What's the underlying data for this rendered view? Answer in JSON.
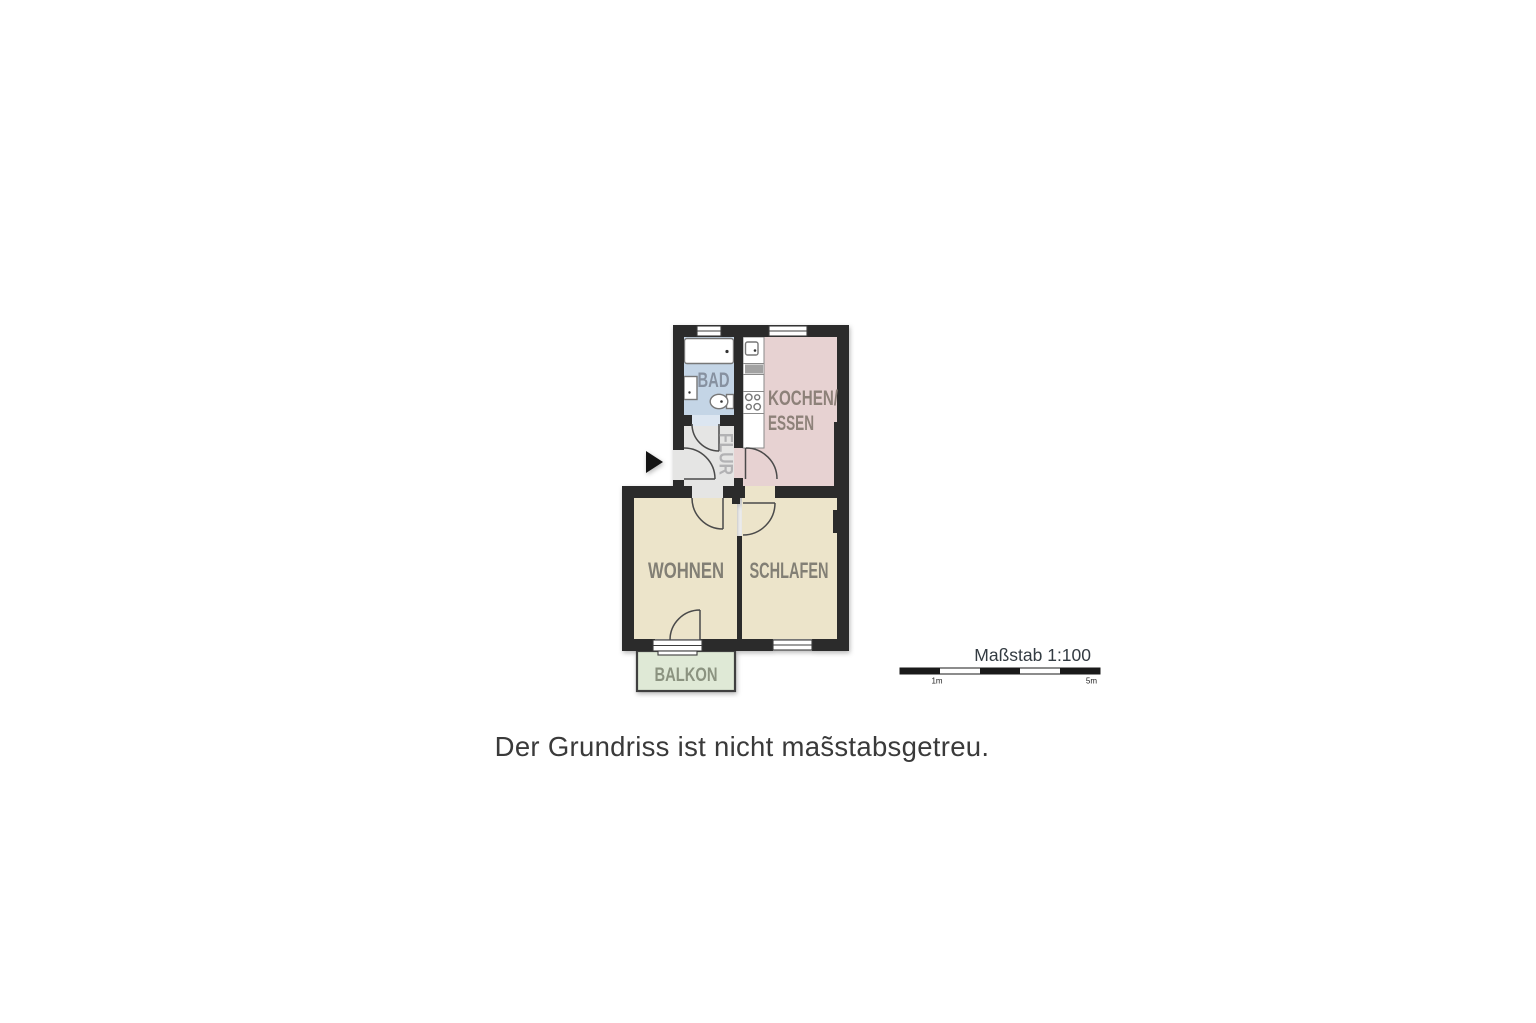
{
  "plan": {
    "rooms": [
      {
        "id": "bad",
        "label": "BAD",
        "fill": "#c4d5e6",
        "label_color": "#8791a0"
      },
      {
        "id": "kochen_essen",
        "label_line1": "KOCHEN/",
        "label_line2": "ESSEN",
        "fill": "#e7d2d2",
        "label_color": "#8d8179"
      },
      {
        "id": "flur",
        "label": "FLUR",
        "fill": "#e5e5e4",
        "label_color": "#b2b2b4"
      },
      {
        "id": "wohnen",
        "label": "WOHNEN",
        "fill": "#ece4ca",
        "label_color": "#827f75"
      },
      {
        "id": "schlafen",
        "label": "SCHLAFEN",
        "fill": "#ece4ca",
        "label_color": "#827f75"
      },
      {
        "id": "balkon",
        "label": "BALKON",
        "fill": "#dfe9d6",
        "label_color": "#8b9380"
      }
    ],
    "fixtures": [
      "bathtub",
      "bath-sink",
      "toilet",
      "kitchen-sink",
      "kitchen-hatch",
      "cooktop"
    ],
    "entrance_marker": "arrow-right"
  },
  "scale": {
    "label": "Maßstab 1:100",
    "tick_first": "1m",
    "tick_last": "5m"
  },
  "caption": {
    "text": "Der Grundriss ist nicht mas̃stabsgetreu."
  },
  "colors": {
    "background": "#ffffff",
    "wall": "#2b2b2b",
    "door": "#4a4a4a",
    "fixture": "#777777",
    "fixture_dot": "#333333",
    "window_frame": "#3c3c3c",
    "bad_door_gap": "#dce6f1",
    "balcony_border": "#3f3f3f",
    "kitchen_outline": "#8a8a8a",
    "arrow": "#141414",
    "scalebar": "#1a1a1a",
    "scaletext": "#333b42",
    "caption": "#3a3a3a"
  }
}
